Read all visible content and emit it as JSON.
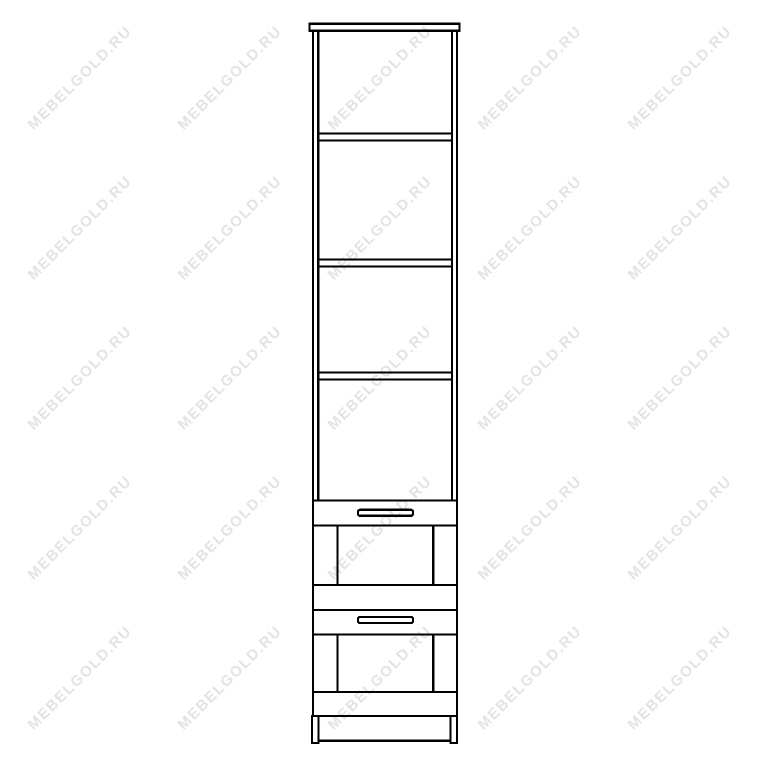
{
  "colors": {
    "background": "#ffffff",
    "line": "#000000",
    "watermark": "#e3e3e3"
  },
  "watermark": {
    "text": "MEBELGOLD.RU",
    "rotation_deg": -45,
    "grid": {
      "start_x": 80,
      "start_y": 78,
      "step_x": 150,
      "step_y": 150,
      "cols": 5,
      "rows": 5
    }
  },
  "diagram": {
    "type": "furniture-line-drawing",
    "view": "front",
    "open_shelf_count": 3,
    "open_compartments": 4,
    "drawer_count": 2,
    "handle_count": 2,
    "has_plinth_feet": true
  }
}
